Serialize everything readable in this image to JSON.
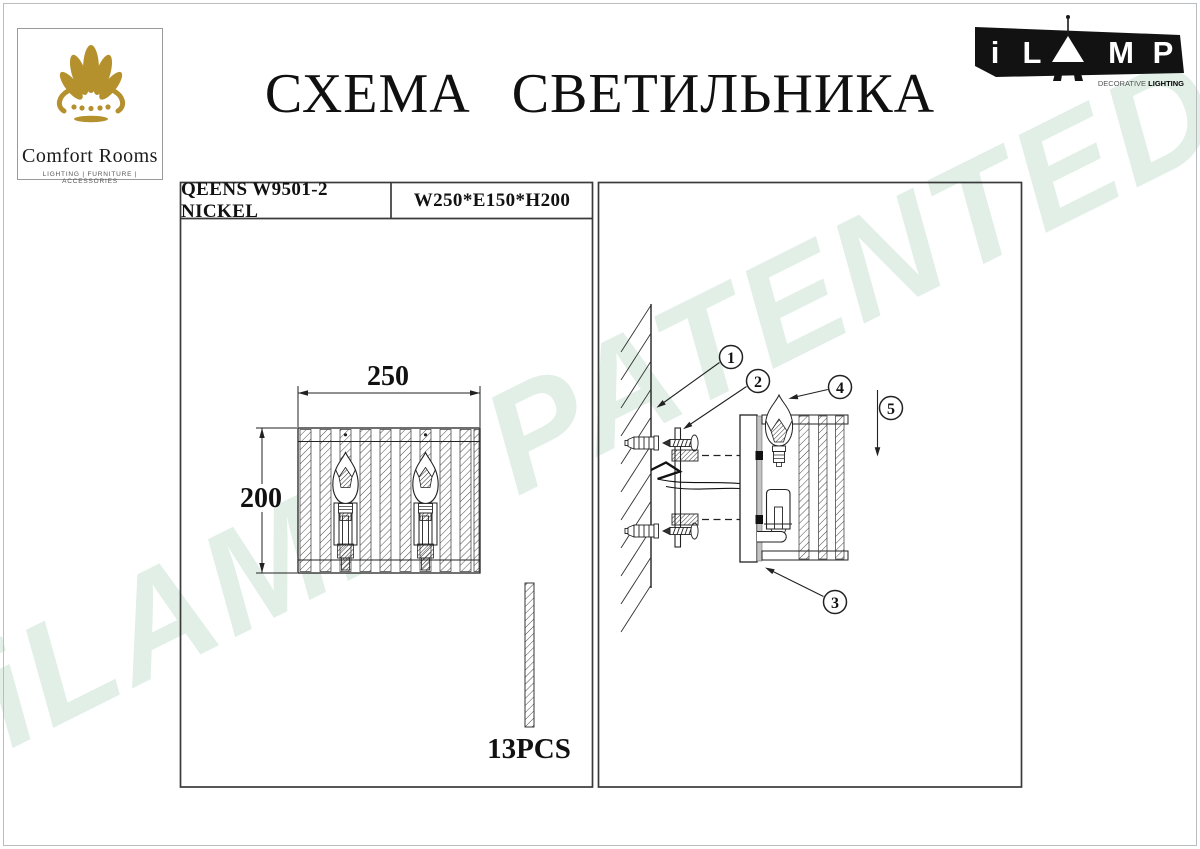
{
  "document": {
    "title": "СХЕМА СВЕТИЛЬНИКА",
    "watermark": "iLAMP PATENTED"
  },
  "comfort_logo": {
    "name": "Comfort Rooms",
    "tagline": "LIGHTING | FURNITURE | ACCESSORIES"
  },
  "ilamp_logo": {
    "letter_i": "i",
    "letter_l": "L",
    "letter_m": "M",
    "letter_p": "P",
    "tagline_light": "DECORATIVE ",
    "tagline_bold": "LIGHTING"
  },
  "spec": {
    "model": "QEENS W9501-2 NICKEL",
    "dimensions": "W250*E150*H200"
  },
  "front_view": {
    "width_mm": "250",
    "height_mm": "200",
    "pieces": "13PCS"
  },
  "assembly": {
    "callouts": [
      "1",
      "2",
      "3",
      "4",
      "5"
    ]
  },
  "colors": {
    "brand_gold": "#b5912e",
    "watermark_green": "#e1efe7",
    "ink": "#222222"
  }
}
